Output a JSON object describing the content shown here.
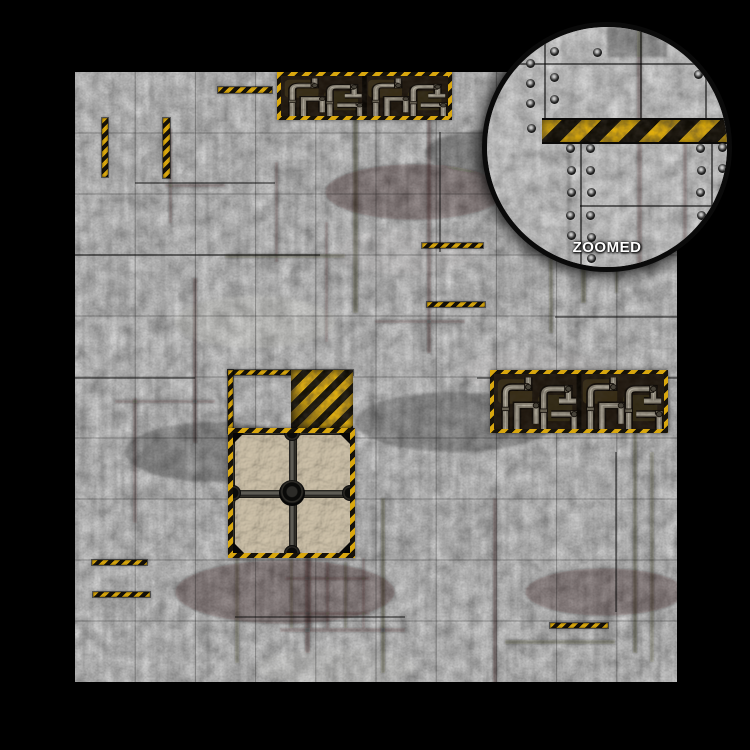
{
  "scene": {
    "background_color": "#000000",
    "subject": "Industrial grimdark gaming battle mat product photo with circular zoomed detail inset"
  },
  "mat": {
    "x": 75,
    "y": 72,
    "width": 602,
    "height": 610,
    "grid": {
      "columns": 10,
      "rows": 10
    },
    "colors": {
      "hazard_yellow": "#D9A70E",
      "hazard_black": "#16120A",
      "concrete_mid": "#8B8B8B",
      "panel_interior": "#1A120B",
      "pipe_gray": "#8F897B",
      "crate_tile_tan": "#B2A389",
      "beam_gray": "#5D5B54"
    },
    "hazard_strips": [
      {
        "x": 27,
        "y": 46,
        "w": 6,
        "h": 59,
        "o": "v"
      },
      {
        "x": 88,
        "y": 46,
        "w": 7,
        "h": 60,
        "o": "v"
      },
      {
        "x": 143,
        "y": 15,
        "w": 54,
        "h": 6,
        "o": "h"
      },
      {
        "x": 347,
        "y": 171,
        "w": 61,
        "h": 5,
        "o": "h"
      },
      {
        "x": 352,
        "y": 230,
        "w": 58,
        "h": 5,
        "o": "h"
      },
      {
        "x": 153,
        "y": 298,
        "w": 125,
        "h": 5,
        "o": "h"
      },
      {
        "x": 153,
        "y": 298,
        "w": 5,
        "h": 63,
        "o": "v"
      },
      {
        "x": 17,
        "y": 488,
        "w": 55,
        "h": 5,
        "o": "h"
      },
      {
        "x": 18,
        "y": 520,
        "w": 57,
        "h": 5,
        "o": "h"
      },
      {
        "x": 475,
        "y": 551,
        "w": 58,
        "h": 5,
        "o": "h"
      }
    ],
    "features": {
      "pipe_panel_top": {
        "x": 202,
        "y": 0,
        "w": 175,
        "h": 48
      },
      "pipe_panel_right": {
        "x": 415,
        "y": 298,
        "w": 178,
        "h": 63
      },
      "hazard_plate": {
        "x": 216,
        "y": 298,
        "w": 62,
        "h": 63
      },
      "crate": {
        "x": 153,
        "y": 356,
        "w": 127,
        "h": 130
      }
    }
  },
  "inset": {
    "label": "ZOOMED",
    "x": 482,
    "y": 22,
    "diameter": 240,
    "band": {
      "x_start": 55,
      "y": 91,
      "height": 22
    },
    "rivets": [
      [
        43,
        36
      ],
      [
        43,
        56
      ],
      [
        43,
        76
      ],
      [
        44,
        101
      ],
      [
        67,
        24
      ],
      [
        67,
        50
      ],
      [
        67,
        72
      ],
      [
        110,
        25
      ],
      [
        83,
        121
      ],
      [
        84,
        143
      ],
      [
        84,
        165
      ],
      [
        83,
        188
      ],
      [
        84,
        208
      ],
      [
        103,
        121
      ],
      [
        103,
        143
      ],
      [
        104,
        165
      ],
      [
        103,
        188
      ],
      [
        104,
        210
      ],
      [
        104,
        231
      ],
      [
        213,
        121
      ],
      [
        214,
        143
      ],
      [
        213,
        165
      ],
      [
        214,
        188
      ],
      [
        235,
        120
      ],
      [
        235,
        141
      ],
      [
        236,
        165
      ],
      [
        210,
        24
      ],
      [
        211,
        47
      ],
      [
        233,
        28
      ],
      [
        232,
        52
      ]
    ]
  }
}
